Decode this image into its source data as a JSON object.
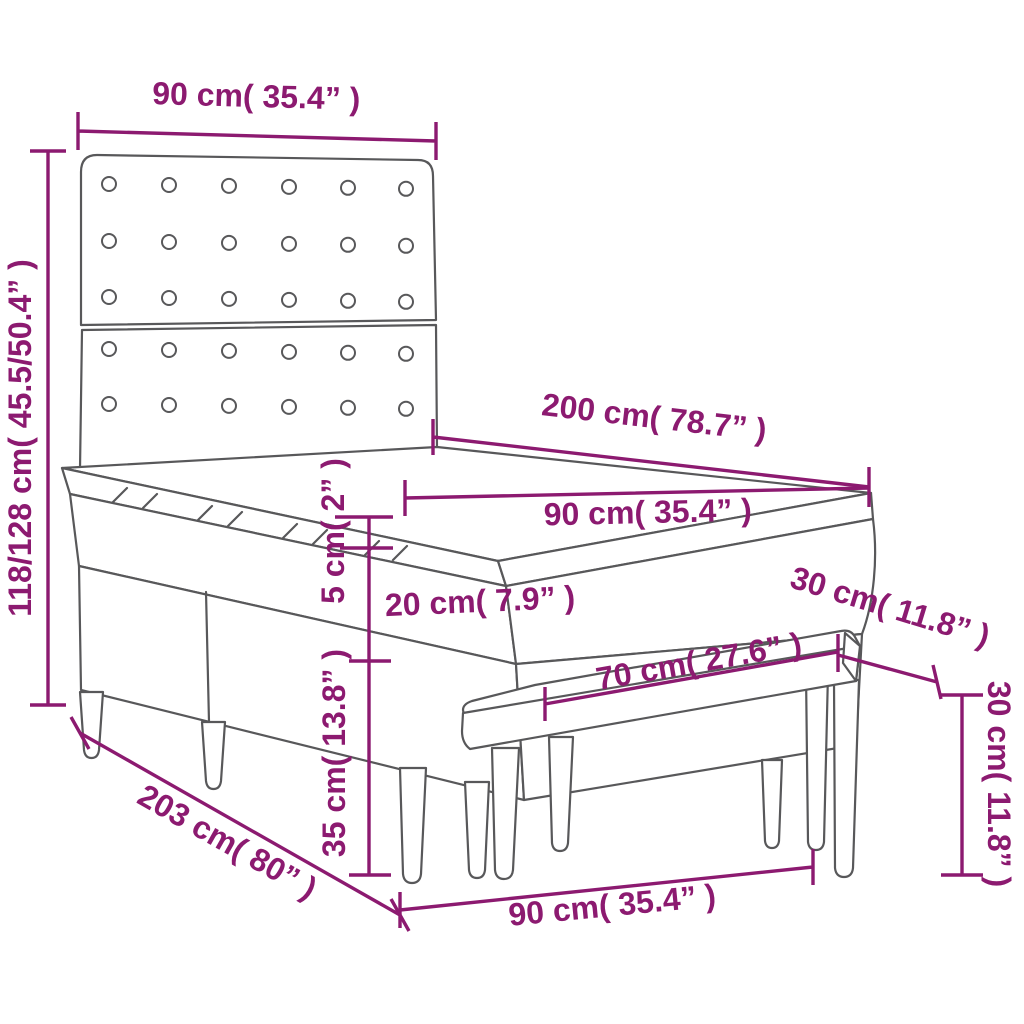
{
  "colors": {
    "dimension": "#8C1A70",
    "outline": "#58585A",
    "background": "#FFFFFF"
  },
  "product": "box-spring-bed-with-tufted-headboard-and-bench",
  "labels": {
    "headboard_width": "90 cm( 35.4” )",
    "overall_height": "118/128 cm( 45.5/50.4” )",
    "bed_length": "200 cm( 78.7” )",
    "mattress_width": "90 cm( 35.4” )",
    "topper_thickness": "5 cm( 2” )",
    "mattress_thickness": "20 cm( 7.9” )",
    "base_height": "35 cm( 13.8” )",
    "bench_seat_depth": "30 cm( 11.8” )",
    "bench_seat_length": "70 cm( 27.6” )",
    "bench_height": "30 cm( 11.8” )",
    "frame_length": "203 cm( 80” )",
    "bench_overall_length": "90 cm( 35.4” )"
  }
}
